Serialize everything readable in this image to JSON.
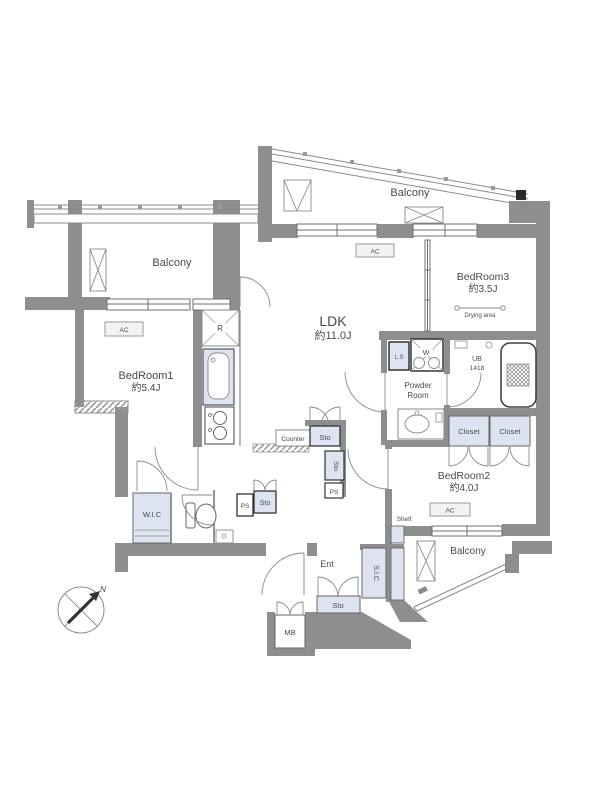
{
  "colors": {
    "wall": "#8e8e8e",
    "fixture_blue": "#dde3f1",
    "label_box": "#f2f2f2",
    "line": "#777777",
    "text": "#4a4a4a"
  },
  "rooms": {
    "ldk": {
      "name": "LDK",
      "size": "約11.0J"
    },
    "bedroom1": {
      "name": "BedRoom1",
      "size": "約5.4J"
    },
    "bedroom2": {
      "name": "BedRoom2",
      "size": "約4.0J"
    },
    "bedroom3": {
      "name": "BedRoom3",
      "size": "約3.5J"
    },
    "powder": {
      "line1": "Powder",
      "line2": "Room"
    },
    "bath": {
      "name": "UB",
      "size": "1418"
    },
    "entrance": "Ent"
  },
  "labels": {
    "balcony": "Balcony",
    "drying_area": "Drying area",
    "closet": "Closet",
    "wic": "W.I.C",
    "counter": "Counter",
    "sto": "Sto",
    "ps": "PS",
    "ls": "L.S",
    "washer": "W",
    "fridge": "R",
    "ac": "AC",
    "shelf": "Shelf",
    "sic": "S.I.C",
    "mb": "MB",
    "north": "N"
  }
}
